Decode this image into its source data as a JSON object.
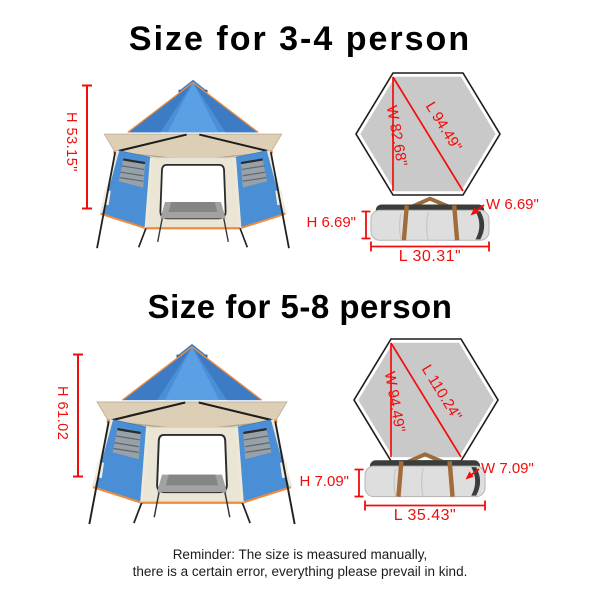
{
  "colors": {
    "accent_red": "#f20d0d",
    "tent_blue": "#4a90d8",
    "awning_beige": "#dccfb6",
    "trim_orange": "#ef8c3c",
    "hexagon_gray": "#c9c9c9",
    "bag_gray": "#dedede",
    "bag_dark": "#3a3e3a",
    "strap_brown": "#a16b3a"
  },
  "sections": [
    {
      "title": "Size for 3-4 person",
      "tent": {
        "height_label": "H 53.15\""
      },
      "footprint": {
        "width_label": "W 82.68\"",
        "length_label": "L 94.49\""
      },
      "bag": {
        "height_label": "H 6.69\"",
        "width_label": "W 6.69\"",
        "length_label": "L 30.31\""
      }
    },
    {
      "title": "Size for 5-8 person",
      "tent": {
        "height_label": "H 61.02"
      },
      "footprint": {
        "width_label": "W 94.49\"",
        "length_label": "L 110.24\""
      },
      "bag": {
        "height_label": "H 7.09\"",
        "width_label": "W 7.09\"",
        "length_label": "L 35.43\""
      }
    }
  ],
  "reminder": {
    "line1": "Reminder: The size is measured manually,",
    "line2": "there is a certain error, everything please prevail in kind."
  }
}
